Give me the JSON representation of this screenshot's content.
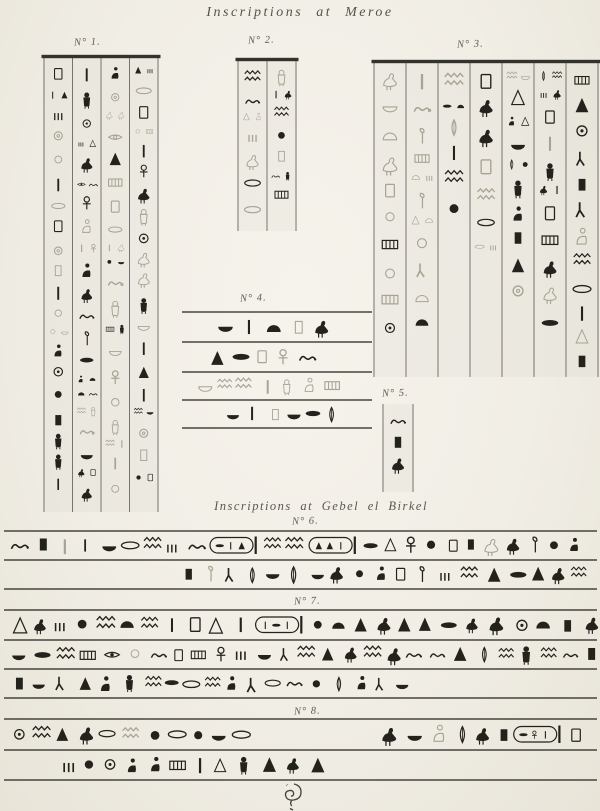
{
  "page": {
    "title": "Inscriptions at Meroe",
    "section2_title": "Inscriptions at Gebel el Birkel",
    "paper_color": "#f2efe7",
    "ink_color": "#24221d",
    "faint_ink": "#97917f",
    "rule_color": "#34322c"
  },
  "labels": {
    "no1": "N° 1.",
    "no2": "N° 2.",
    "no3": "N° 3.",
    "no4": "N° 4.",
    "no5": "N° 5.",
    "no6": "N° 6.",
    "no7": "N° 7.",
    "no8": "N° 8."
  },
  "blocks": {
    "no1": {
      "kind": "vcols",
      "x": 44,
      "y": 58,
      "w": 114,
      "h": 454,
      "cols": 4,
      "topbar": true,
      "seed": 11,
      "fade": [
        0.45,
        0.2,
        0.65,
        0.25
      ],
      "fill": [
        1,
        1,
        1,
        0.97
      ]
    },
    "no2": {
      "kind": "vcols",
      "x": 238,
      "y": 61,
      "w": 58,
      "h": 170,
      "cols": 2,
      "topbar": true,
      "seed": 22,
      "fade": [
        0.25,
        0.3
      ],
      "fill": [
        1,
        0.93
      ]
    },
    "no3": {
      "kind": "vcols",
      "x": 374,
      "y": 63,
      "w": 224,
      "h": 314,
      "cols": 7,
      "topbar": true,
      "seed": 33,
      "fade": [
        0.85,
        0.8,
        0.25,
        0.2,
        0.2,
        0.2,
        0.2
      ],
      "fill": [
        0.92,
        0.9,
        0.55,
        0.62,
        0.78,
        0.88,
        0.97
      ]
    },
    "no5": {
      "kind": "vcols",
      "x": 383,
      "y": 404,
      "w": 30,
      "h": 88,
      "cols": 1,
      "topbar": false,
      "seed": 55,
      "fade": [
        0.08
      ],
      "fill": [
        1
      ]
    },
    "no4": {
      "kind": "hrows",
      "x": 182,
      "y": 312,
      "w": 190,
      "h": 116,
      "seed": 44,
      "rules": [
        0,
        30,
        60,
        88,
        116
      ],
      "rows": [
        {
          "y0": 0,
          "y1": 30,
          "fade": 0.08,
          "segments": [
            {
              "span": [
                0.17,
                0.78
              ]
            }
          ]
        },
        {
          "y0": 30,
          "y1": 60,
          "fade": 0.08,
          "segments": [
            {
              "span": [
                0.13,
                0.76
              ]
            }
          ]
        },
        {
          "y0": 60,
          "y1": 88,
          "fade": 1,
          "segments": [
            {
              "span": [
                0.07,
                0.88
              ]
            }
          ]
        },
        {
          "y0": 88,
          "y1": 116,
          "fade": 0.04,
          "segments": [
            {
              "span": [
                0.22,
                0.8
              ]
            }
          ]
        }
      ]
    },
    "no6": {
      "kind": "hrows",
      "x": 4,
      "y": 531,
      "w": 593,
      "h": 58,
      "seed": 66,
      "rules": [
        0,
        29,
        58
      ],
      "rows": [
        {
          "y0": 0,
          "y1": 29,
          "fade": 0.02,
          "segments": [
            {
              "span": [
                0.008,
                0.99
              ],
              "cartouches": [
                0.355,
                0.515
              ]
            }
          ]
        },
        {
          "y0": 29,
          "y1": 58,
          "fade": 0.02,
          "segments": [
            {
              "span": [
                0.295,
                0.995
              ]
            }
          ]
        }
      ]
    },
    "no7": {
      "kind": "hrows",
      "x": 4,
      "y": 610,
      "w": 593,
      "h": 88,
      "seed": 77,
      "rules": [
        0,
        30,
        59,
        88
      ],
      "rows": [
        {
          "y0": 0,
          "y1": 30,
          "fade": 0.02,
          "segments": [
            {
              "span": [
                0.008,
                0.99
              ],
              "cartouches": [
                0.425
              ]
            }
          ]
        },
        {
          "y0": 30,
          "y1": 59,
          "fade": 0.02,
          "segments": [
            {
              "span": [
                0.008,
                0.99
              ]
            }
          ]
        },
        {
          "y0": 59,
          "y1": 88,
          "fade": 0.02,
          "segments": [
            {
              "span": [
                0.008,
                0.7
              ]
            }
          ]
        }
      ]
    },
    "no8": {
      "kind": "hrows",
      "x": 4,
      "y": 719,
      "w": 593,
      "h": 61,
      "seed": 88,
      "rules": [
        0,
        31,
        61
      ],
      "rows": [
        {
          "y0": 0,
          "y1": 31,
          "fade": 0.02,
          "segments": [
            {
              "span": [
                0.008,
                0.42
              ]
            },
            {
              "span": [
                0.63,
                0.99
              ],
              "cartouches": [
                0.85
              ]
            }
          ]
        },
        {
          "y0": 31,
          "y1": 61,
          "fade": 0.04,
          "segments": [
            {
              "span": [
                0.09,
                0.55
              ]
            }
          ]
        }
      ]
    },
    "flourish": {
      "x": 276,
      "y": 782,
      "w": 34,
      "h": 30
    }
  }
}
